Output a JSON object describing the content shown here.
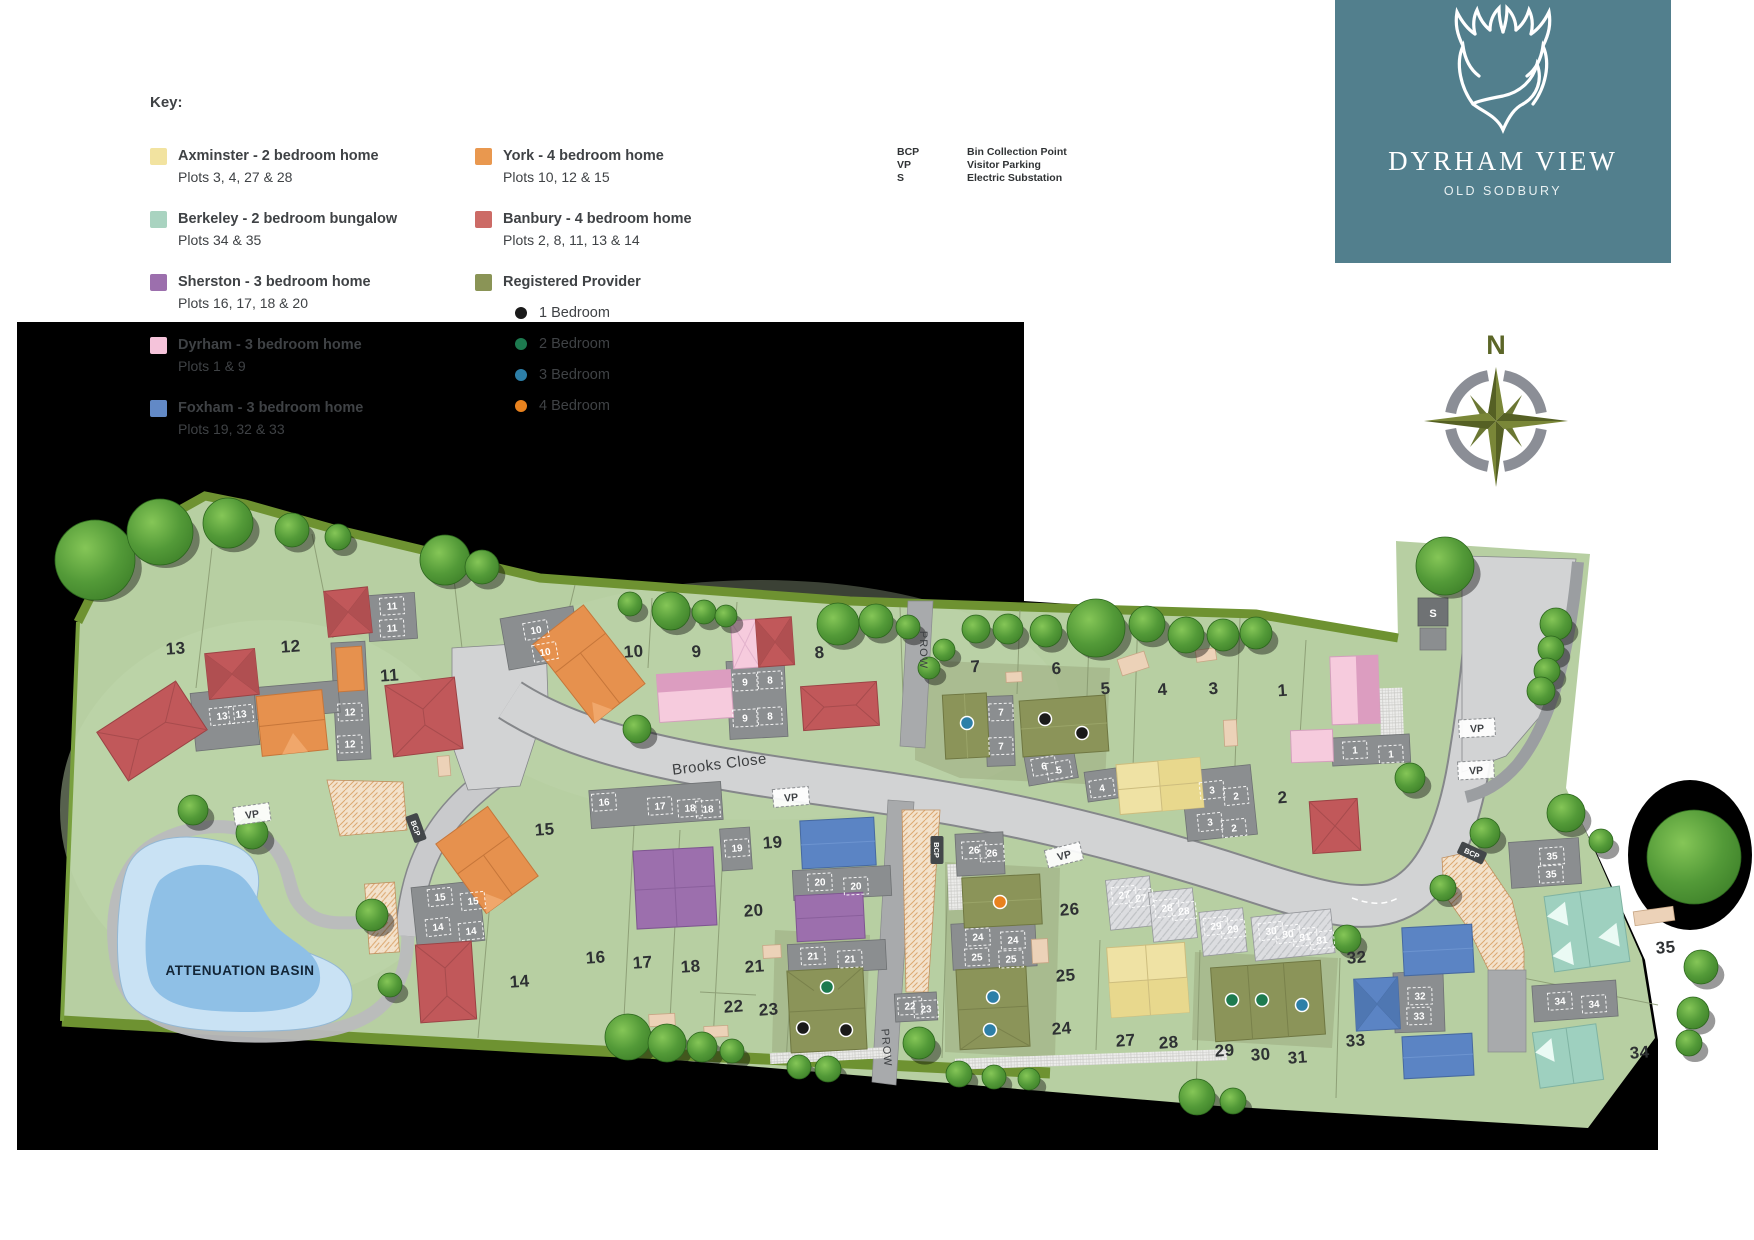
{
  "legend": {
    "title": "Key:",
    "house_types": [
      {
        "label": "Axminster - 2 bedroom home",
        "plots": "Plots 3, 4, 27 & 28",
        "color": "#f2e3a0",
        "col": 1
      },
      {
        "label": "Berkeley - 2 bedroom bungalow",
        "plots": "Plots 34 & 35",
        "color": "#a9d3c0",
        "col": 1
      },
      {
        "label": "Sherston - 3 bedroom home",
        "plots": "Plots 16, 17, 18 & 20",
        "color": "#9c6fad",
        "col": 1
      },
      {
        "label": "Dyrham - 3 bedroom home",
        "plots": "Plots 1 & 9",
        "color": "#f5c3da",
        "col": 1
      },
      {
        "label": "Foxham - 3 bedroom home",
        "plots": "Plots 19, 32 & 33",
        "color": "#6289c6",
        "col": 1
      },
      {
        "label": "York - 4 bedroom home",
        "plots": "Plots 10, 12 & 15",
        "color": "#e9984f",
        "col": 2
      },
      {
        "label": "Banbury - 4 bedroom home",
        "plots": "Plots 2, 8, 11, 13 & 14",
        "color": "#cc6b66",
        "col": 2
      }
    ],
    "registered_provider": {
      "label": "Registered Provider",
      "color": "#8a9456",
      "bedrooms": [
        {
          "label": "1 Bedroom",
          "color": "#1a1a1a"
        },
        {
          "label": "2 Bedroom",
          "color": "#1d7a4f"
        },
        {
          "label": "3 Bedroom",
          "color": "#2d7fa8"
        },
        {
          "label": "4 Bedroom",
          "color": "#e8821e"
        }
      ]
    },
    "abbreviations": [
      {
        "abbr": "BCP",
        "meaning": "Bin Collection Point"
      },
      {
        "abbr": "VP",
        "meaning": "Visitor Parking"
      },
      {
        "abbr": "S",
        "meaning": "Electric Substation"
      }
    ]
  },
  "logo": {
    "title": "DYRHAM VIEW",
    "subtitle": "OLD SODBURY",
    "bg_color": "#527f8d",
    "icon": "stag-antlers-icon"
  },
  "compass": {
    "north_label": "N"
  },
  "map": {
    "road_name": "Brooks Close",
    "basin_label": "ATTENUATION BASIN",
    "substation_label": "S",
    "prow_labels": [
      {
        "text": "PROW",
        "x": 920,
        "y": 650,
        "rot": 90
      },
      {
        "text": "PROW",
        "x": 883,
        "y": 1048,
        "rot": 85
      }
    ],
    "vp_markers": [
      {
        "text": "VP",
        "x": 252,
        "y": 814,
        "rot": -8
      },
      {
        "text": "VP",
        "x": 791,
        "y": 797,
        "rot": -5
      },
      {
        "text": "VP",
        "x": 1064,
        "y": 855,
        "rot": -14
      },
      {
        "text": "VP",
        "x": 1477,
        "y": 728,
        "rot": -3
      },
      {
        "text": "VP",
        "x": 1476,
        "y": 770,
        "rot": -3
      }
    ],
    "bcp_markers": [
      {
        "text": "BCP",
        "x": 416,
        "y": 828,
        "rot": 70
      },
      {
        "text": "BCP",
        "x": 937,
        "y": 850,
        "rot": 90
      },
      {
        "text": "BCP",
        "x": 1472,
        "y": 853,
        "rot": 25
      }
    ],
    "plot_numbers": [
      {
        "n": "1",
        "x": 1283,
        "y": 696
      },
      {
        "n": "2",
        "x": 1283,
        "y": 803
      },
      {
        "n": "3",
        "x": 1214,
        "y": 694
      },
      {
        "n": "4",
        "x": 1163,
        "y": 695
      },
      {
        "n": "5",
        "x": 1106,
        "y": 694
      },
      {
        "n": "6",
        "x": 1057,
        "y": 674
      },
      {
        "n": "7",
        "x": 976,
        "y": 672
      },
      {
        "n": "8",
        "x": 820,
        "y": 658
      },
      {
        "n": "9",
        "x": 697,
        "y": 657
      },
      {
        "n": "10",
        "x": 634,
        "y": 657
      },
      {
        "n": "11",
        "x": 390,
        "y": 681
      },
      {
        "n": "12",
        "x": 291,
        "y": 652
      },
      {
        "n": "13",
        "x": 176,
        "y": 654
      },
      {
        "n": "14",
        "x": 520,
        "y": 987
      },
      {
        "n": "15",
        "x": 545,
        "y": 835
      },
      {
        "n": "16",
        "x": 596,
        "y": 963
      },
      {
        "n": "17",
        "x": 643,
        "y": 968
      },
      {
        "n": "18",
        "x": 691,
        "y": 972
      },
      {
        "n": "19",
        "x": 773,
        "y": 848
      },
      {
        "n": "20",
        "x": 754,
        "y": 916
      },
      {
        "n": "21",
        "x": 755,
        "y": 972
      },
      {
        "n": "22",
        "x": 734,
        "y": 1012
      },
      {
        "n": "23",
        "x": 769,
        "y": 1015
      },
      {
        "n": "24",
        "x": 1062,
        "y": 1034
      },
      {
        "n": "25",
        "x": 1066,
        "y": 981
      },
      {
        "n": "26",
        "x": 1070,
        "y": 915
      },
      {
        "n": "27",
        "x": 1126,
        "y": 1046
      },
      {
        "n": "28",
        "x": 1169,
        "y": 1048
      },
      {
        "n": "29",
        "x": 1225,
        "y": 1056
      },
      {
        "n": "30",
        "x": 1261,
        "y": 1060
      },
      {
        "n": "31",
        "x": 1298,
        "y": 1063
      },
      {
        "n": "32",
        "x": 1357,
        "y": 963
      },
      {
        "n": "33",
        "x": 1356,
        "y": 1046
      },
      {
        "n": "34",
        "x": 1640,
        "y": 1058
      },
      {
        "n": "35",
        "x": 1666,
        "y": 953
      }
    ],
    "parking_bays": [
      {
        "n": "11",
        "x": 392,
        "y": 606,
        "rot": -4
      },
      {
        "n": "11",
        "x": 392,
        "y": 628,
        "rot": -4
      },
      {
        "n": "13",
        "x": 222,
        "y": 716,
        "rot": -6
      },
      {
        "n": "13",
        "x": 241,
        "y": 714,
        "rot": -6
      },
      {
        "n": "12",
        "x": 350,
        "y": 712,
        "rot": -3
      },
      {
        "n": "12",
        "x": 350,
        "y": 744,
        "rot": -3
      },
      {
        "n": "10",
        "x": 536,
        "y": 630,
        "rot": -10
      },
      {
        "n": "10",
        "x": 545,
        "y": 652,
        "rot": -10
      },
      {
        "n": "9",
        "x": 745,
        "y": 682,
        "rot": -3
      },
      {
        "n": "8",
        "x": 770,
        "y": 680,
        "rot": -3
      },
      {
        "n": "9",
        "x": 745,
        "y": 718,
        "rot": -3
      },
      {
        "n": "8",
        "x": 770,
        "y": 716,
        "rot": -3
      },
      {
        "n": "7",
        "x": 1001,
        "y": 712,
        "rot": -2
      },
      {
        "n": "7",
        "x": 1001,
        "y": 746,
        "rot": -2
      },
      {
        "n": "6",
        "x": 1044,
        "y": 766,
        "rot": -10
      },
      {
        "n": "5",
        "x": 1059,
        "y": 770,
        "rot": -10
      },
      {
        "n": "4",
        "x": 1102,
        "y": 788,
        "rot": -8
      },
      {
        "n": "3",
        "x": 1212,
        "y": 790,
        "rot": -6
      },
      {
        "n": "2",
        "x": 1236,
        "y": 796,
        "rot": -6
      },
      {
        "n": "3",
        "x": 1210,
        "y": 822,
        "rot": -6
      },
      {
        "n": "2",
        "x": 1234,
        "y": 828,
        "rot": -6
      },
      {
        "n": "1",
        "x": 1355,
        "y": 750,
        "rot": -3
      },
      {
        "n": "1",
        "x": 1391,
        "y": 754,
        "rot": -3
      },
      {
        "n": "15",
        "x": 440,
        "y": 897,
        "rot": -6
      },
      {
        "n": "15",
        "x": 473,
        "y": 901,
        "rot": -6
      },
      {
        "n": "14",
        "x": 438,
        "y": 927,
        "rot": -6
      },
      {
        "n": "14",
        "x": 471,
        "y": 931,
        "rot": -6
      },
      {
        "n": "16",
        "x": 604,
        "y": 802,
        "rot": -4
      },
      {
        "n": "17",
        "x": 660,
        "y": 806,
        "rot": -4
      },
      {
        "n": "18",
        "x": 690,
        "y": 808,
        "rot": -4
      },
      {
        "n": "18",
        "x": 708,
        "y": 809,
        "rot": -4
      },
      {
        "n": "19",
        "x": 737,
        "y": 848,
        "rot": -4
      },
      {
        "n": "20",
        "x": 820,
        "y": 882,
        "rot": -3
      },
      {
        "n": "20",
        "x": 856,
        "y": 886,
        "rot": -3
      },
      {
        "n": "21",
        "x": 813,
        "y": 956,
        "rot": -3
      },
      {
        "n": "21",
        "x": 850,
        "y": 959,
        "rot": -3
      },
      {
        "n": "22",
        "x": 910,
        "y": 1006,
        "rot": -3
      },
      {
        "n": "23",
        "x": 926,
        "y": 1009,
        "rot": -3
      },
      {
        "n": "26",
        "x": 974,
        "y": 850,
        "rot": -3
      },
      {
        "n": "26",
        "x": 992,
        "y": 853,
        "rot": -3
      },
      {
        "n": "24",
        "x": 978,
        "y": 937,
        "rot": -3
      },
      {
        "n": "24",
        "x": 1013,
        "y": 940,
        "rot": -3
      },
      {
        "n": "25",
        "x": 977,
        "y": 957,
        "rot": -3
      },
      {
        "n": "25",
        "x": 1011,
        "y": 959,
        "rot": -3
      },
      {
        "n": "27",
        "x": 1124,
        "y": 895,
        "rot": -6
      },
      {
        "n": "27",
        "x": 1141,
        "y": 898,
        "rot": -6
      },
      {
        "n": "28",
        "x": 1167,
        "y": 908,
        "rot": -6
      },
      {
        "n": "28",
        "x": 1184,
        "y": 911,
        "rot": -6
      },
      {
        "n": "29",
        "x": 1216,
        "y": 926,
        "rot": -6
      },
      {
        "n": "29",
        "x": 1233,
        "y": 929,
        "rot": -6
      },
      {
        "n": "30",
        "x": 1271,
        "y": 931,
        "rot": -6
      },
      {
        "n": "30",
        "x": 1288,
        "y": 934,
        "rot": -6
      },
      {
        "n": "31",
        "x": 1305,
        "y": 937,
        "rot": -6
      },
      {
        "n": "31",
        "x": 1322,
        "y": 940,
        "rot": -6
      },
      {
        "n": "32",
        "x": 1420,
        "y": 996,
        "rot": -2
      },
      {
        "n": "33",
        "x": 1419,
        "y": 1016,
        "rot": -2
      },
      {
        "n": "34",
        "x": 1560,
        "y": 1001,
        "rot": -4
      },
      {
        "n": "34",
        "x": 1594,
        "y": 1004,
        "rot": -4
      },
      {
        "n": "35",
        "x": 1552,
        "y": 856,
        "rot": -4
      },
      {
        "n": "35",
        "x": 1551,
        "y": 874,
        "rot": -4
      }
    ],
    "bedroom_dots": [
      {
        "type": "1 Bedroom",
        "color": "#1a1a1a",
        "x": 1045,
        "y": 719
      },
      {
        "type": "1 Bedroom",
        "color": "#1a1a1a",
        "x": 1082,
        "y": 733
      },
      {
        "type": "1 Bedroom",
        "color": "#1a1a1a",
        "x": 803,
        "y": 1028
      },
      {
        "type": "1 Bedroom",
        "color": "#1a1a1a",
        "x": 846,
        "y": 1030
      },
      {
        "type": "2 Bedroom",
        "color": "#1d7a4f",
        "x": 827,
        "y": 987
      },
      {
        "type": "2 Bedroom",
        "color": "#1d7a4f",
        "x": 1232,
        "y": 1000
      },
      {
        "type": "2 Bedroom",
        "color": "#1d7a4f",
        "x": 1262,
        "y": 1000
      },
      {
        "type": "3 Bedroom",
        "color": "#2d7fa8",
        "x": 967,
        "y": 723
      },
      {
        "type": "3 Bedroom",
        "color": "#2d7fa8",
        "x": 993,
        "y": 997
      },
      {
        "type": "3 Bedroom",
        "color": "#2d7fa8",
        "x": 990,
        "y": 1030
      },
      {
        "type": "3 Bedroom",
        "color": "#2d7fa8",
        "x": 1302,
        "y": 1005
      },
      {
        "type": "4 Bedroom",
        "color": "#e8821e",
        "x": 1000,
        "y": 902
      }
    ]
  }
}
